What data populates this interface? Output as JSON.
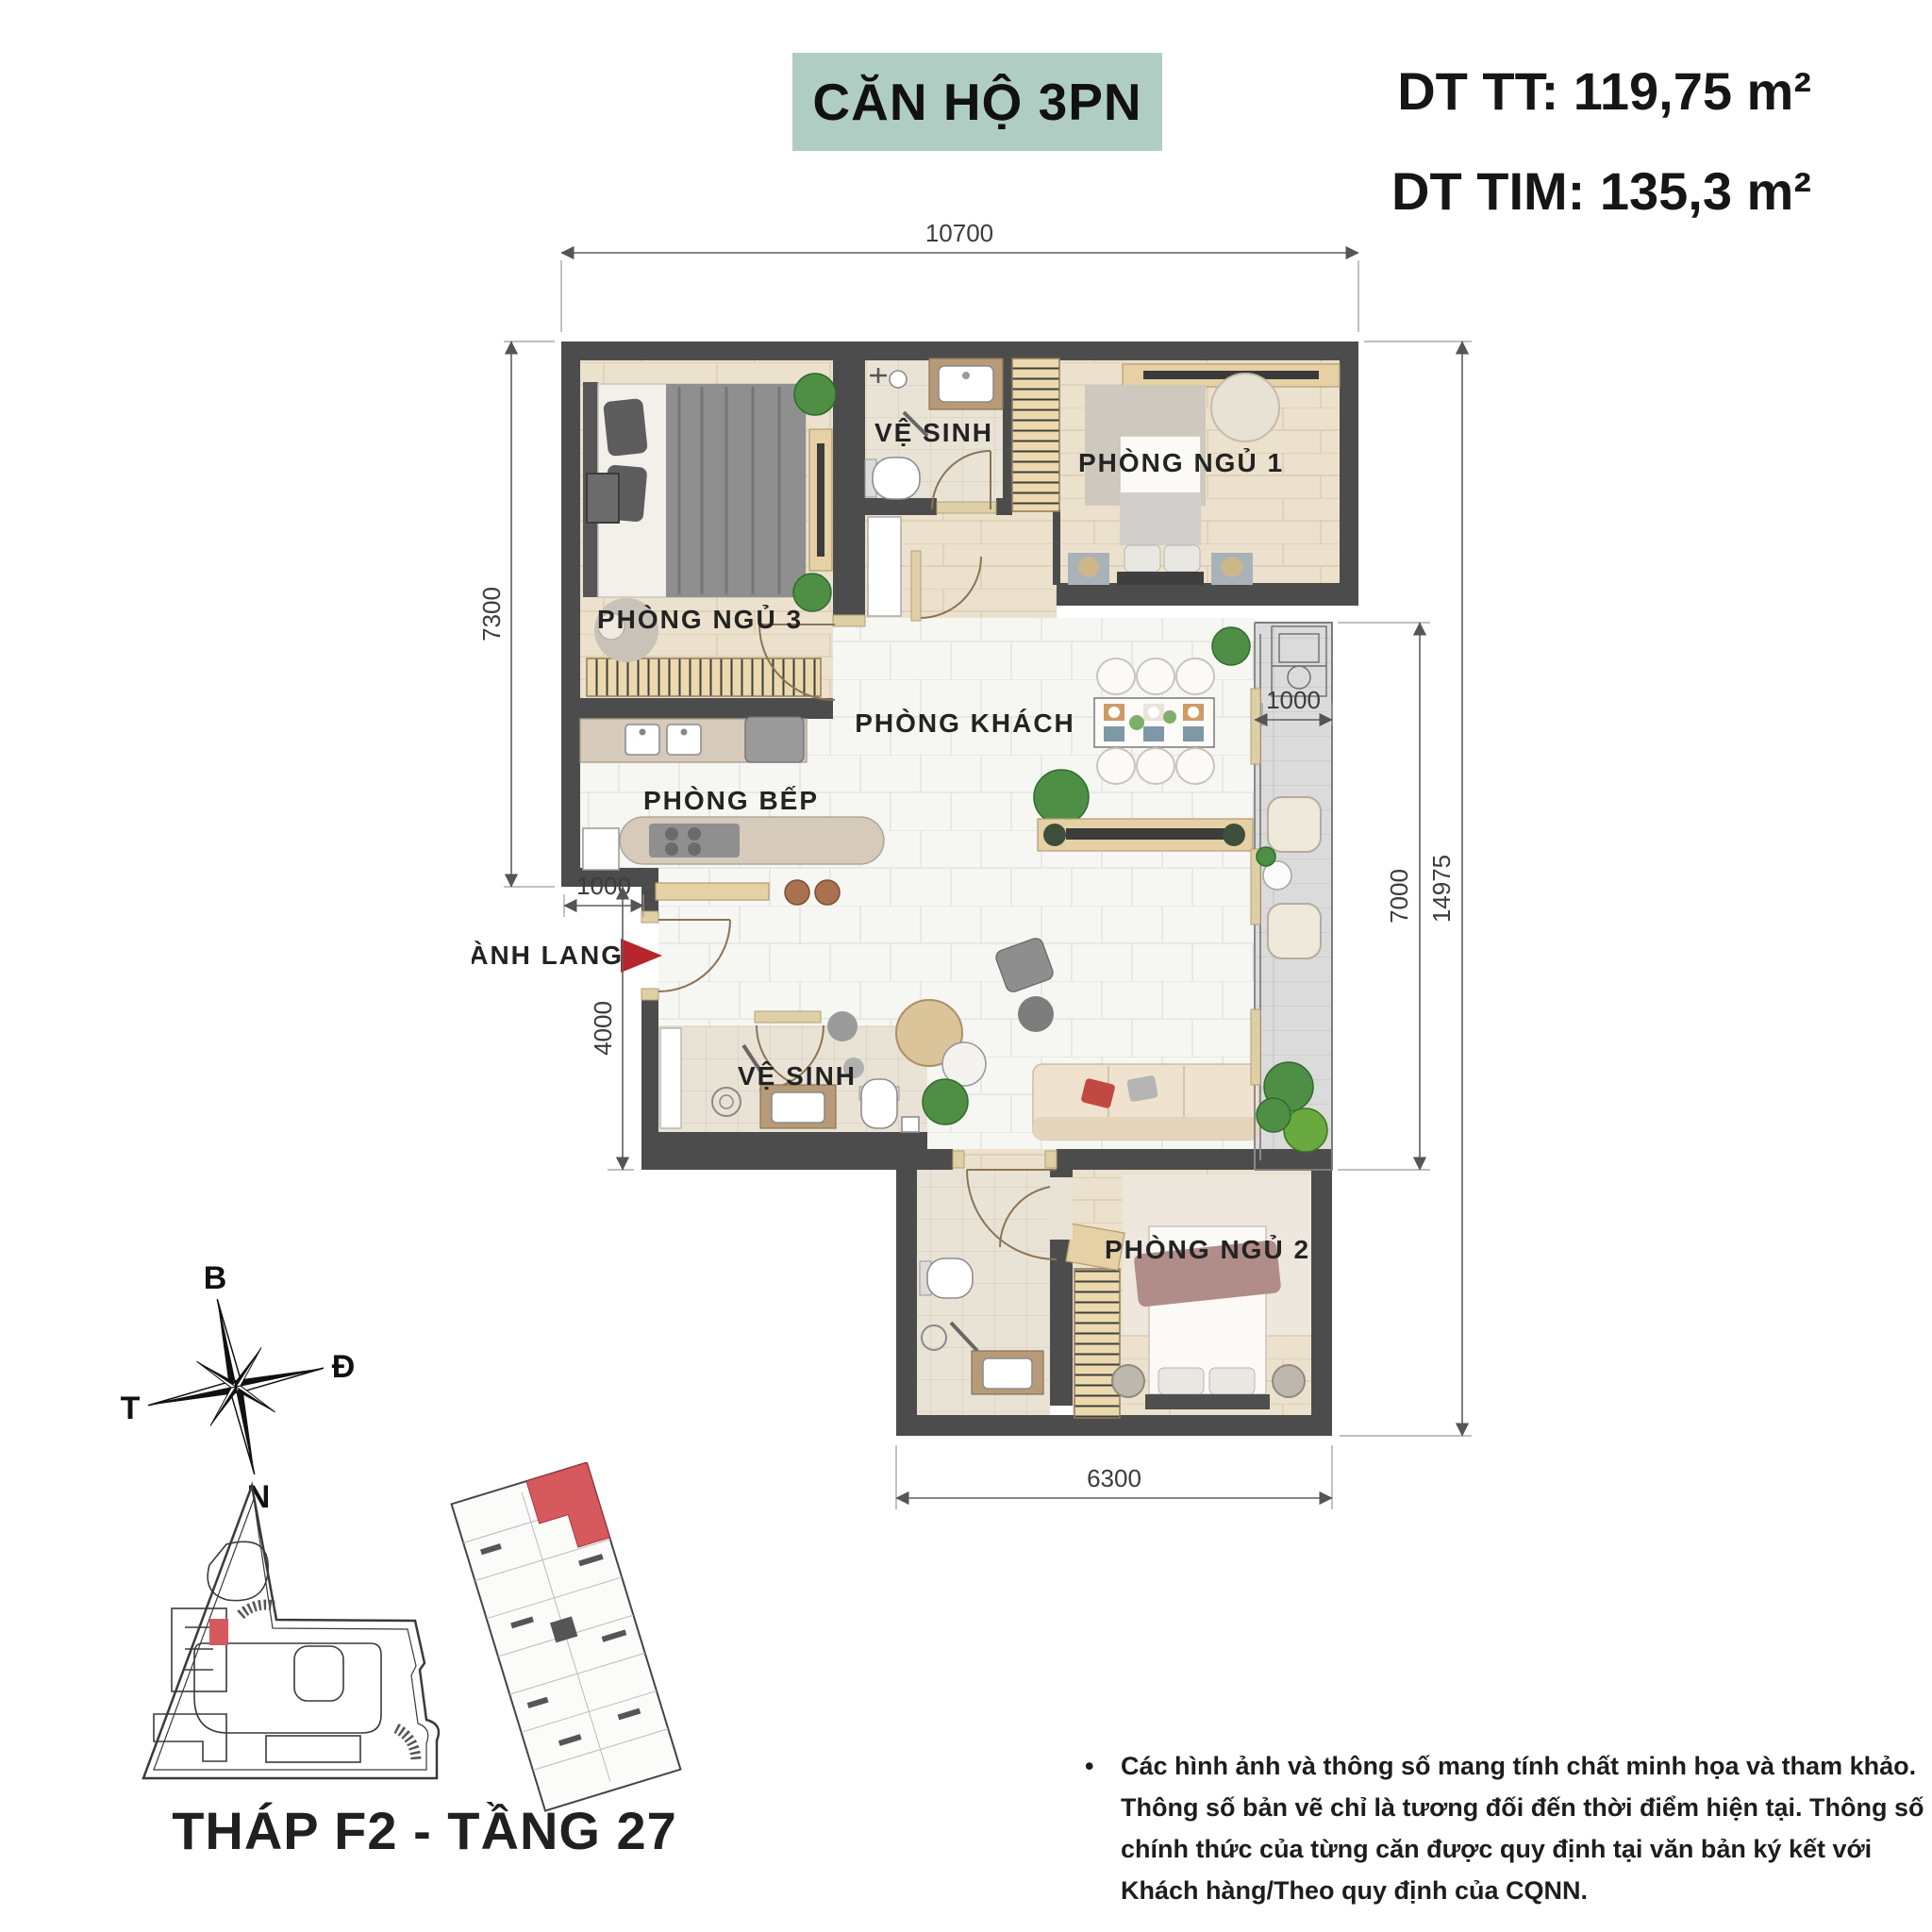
{
  "header": {
    "title": "CĂN HỘ 3PN",
    "area_tt": "DT TT: 119,75 m²",
    "area_tim": "DT TIM: 135,3 m²"
  },
  "plan": {
    "room_labels": {
      "bedroom3": "PHÒNG NGỦ 3",
      "bathroom1": "VỆ SINH",
      "bedroom1": "PHÒNG NGỦ 1",
      "living": "PHÒNG KHÁCH",
      "kitchen": "PHÒNG BẾP",
      "hallway": "HÀNH LANG",
      "bathroom2": "VỆ SINH",
      "bedroom2": "PHÒNG NGỦ 2"
    },
    "dimensions": {
      "top_width": "10700",
      "left_upper": "7300",
      "entry_width": "1000",
      "left_lower": "4000",
      "bottom_width": "6300",
      "balcony_width": "1000",
      "balcony_length": "7000",
      "right_total": "14975"
    }
  },
  "compass": {
    "north": "B",
    "east": "Đ",
    "south": "N",
    "west": "T"
  },
  "site_plan": {
    "caption": "THÁP F2 - TẦNG 27"
  },
  "disclaimer": {
    "bullet": "•",
    "lines": [
      "Các hình ảnh và thông số mang tính chất minh họa và tham khảo.",
      "Thông số bản vẽ chỉ là tương đối đến thời điểm hiện tại. Thông số",
      "chính thức của từng căn được quy định tại văn bản ký kết với",
      "Khách hàng/Theo quy định của CQNN."
    ]
  },
  "colors": {
    "accent_teal": "#b0cdc4",
    "wall_gray": "#4c4c4d",
    "highlight_red": "#c8474c"
  }
}
